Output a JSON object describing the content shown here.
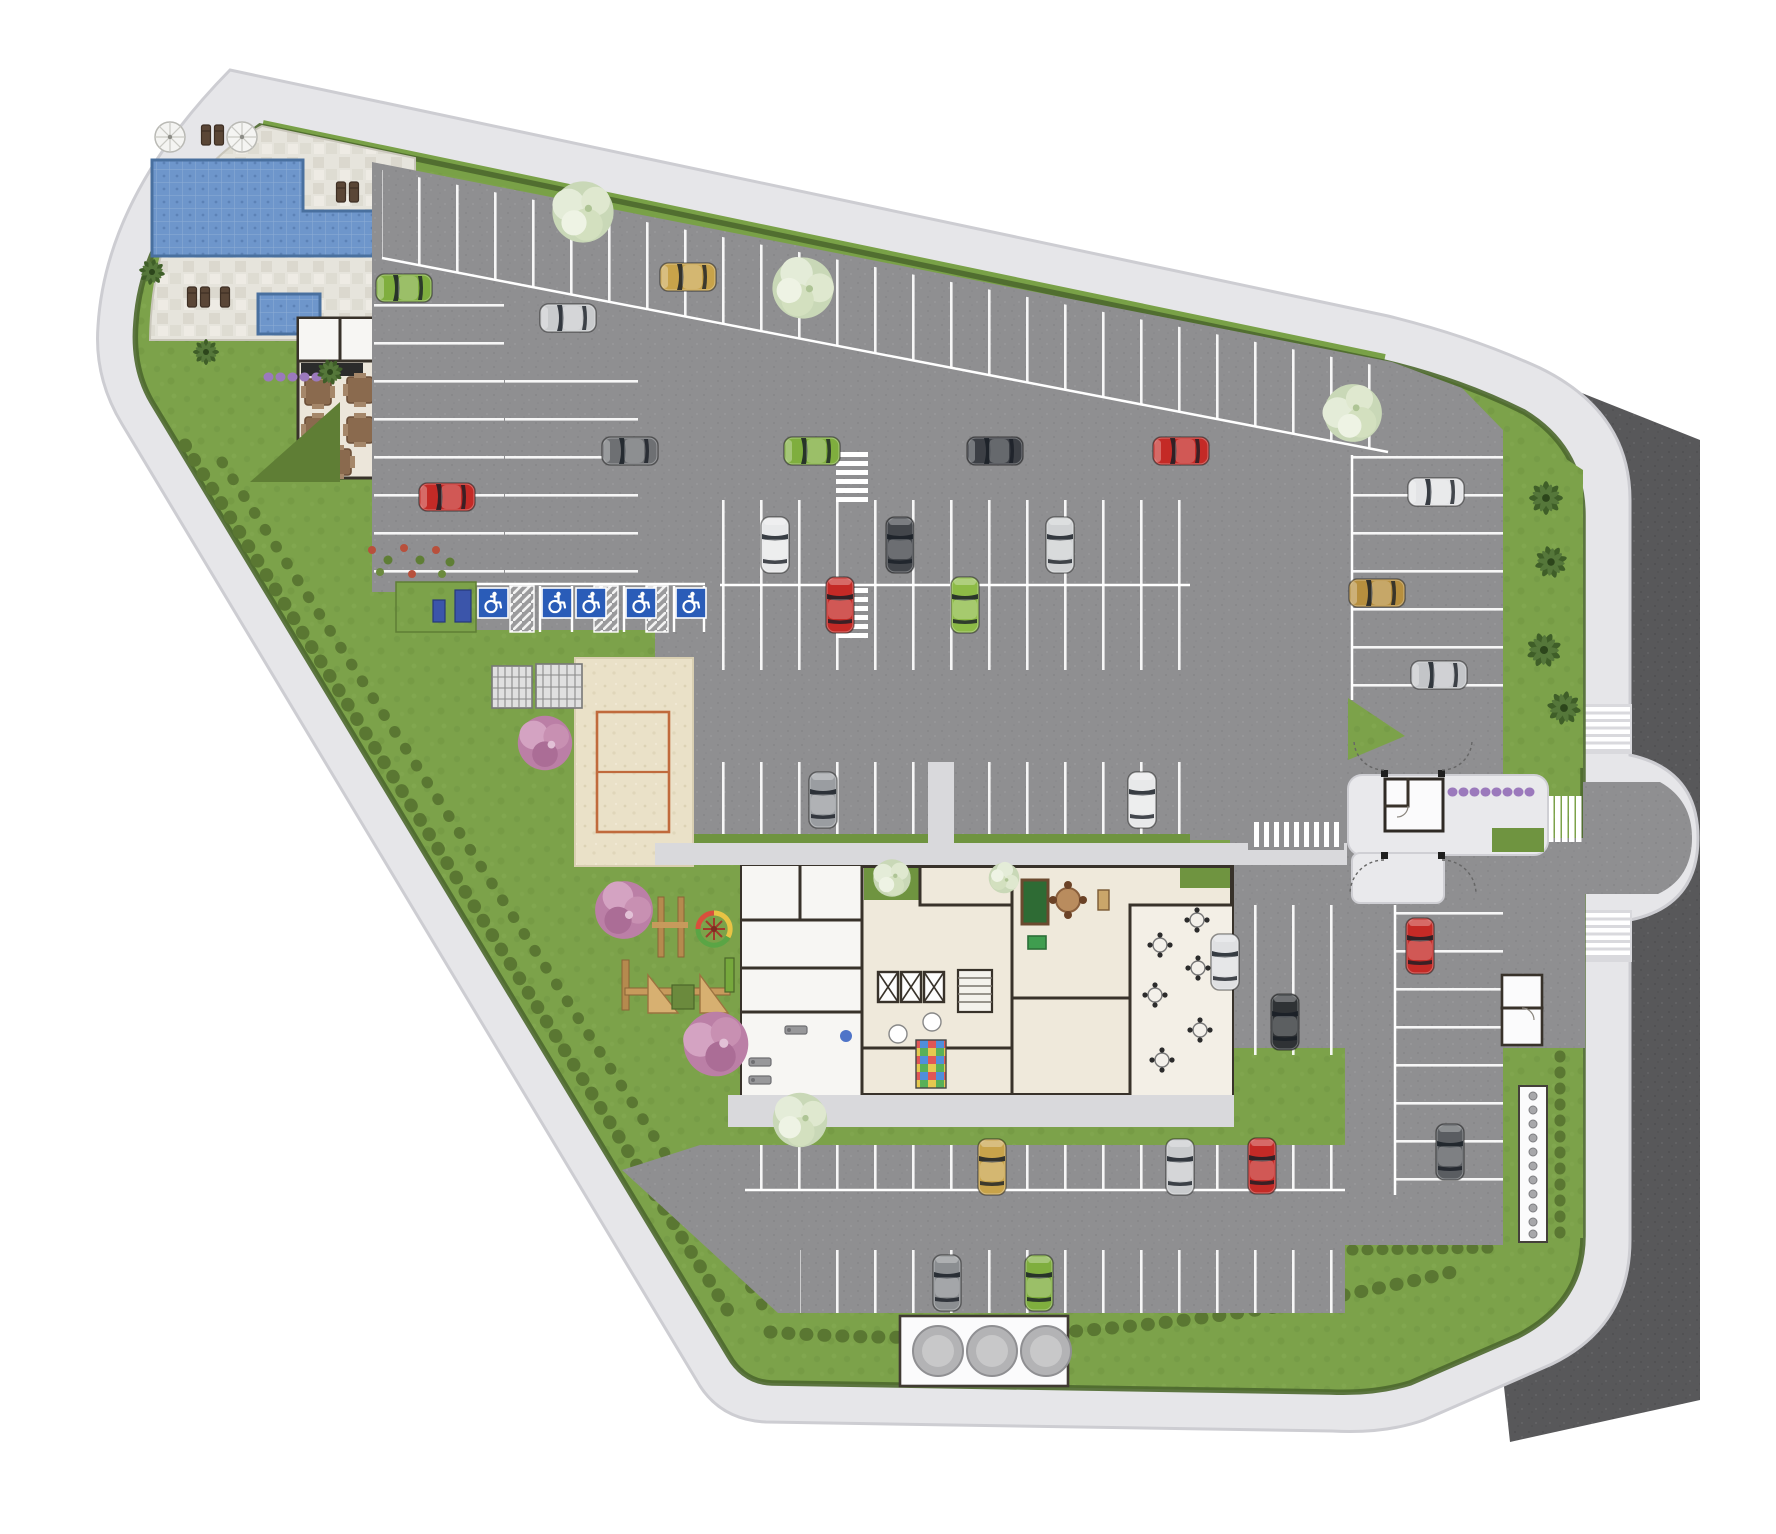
{
  "site": {
    "type": "residential-condominium-site-plan",
    "features": [
      "swimming-pool",
      "children-pool",
      "sun-deck",
      "pool-terrace-with-tables",
      "beach-sport-court",
      "playground",
      "apartment-building-floorplan",
      "party-room",
      "game-room",
      "gym",
      "guardhouse",
      "entrance-gate",
      "water-tanks",
      "perimeter-sidewalk",
      "street",
      "parking-lots"
    ],
    "counts": {
      "accessible_parking_spaces": 5,
      "water_tanks": 3,
      "elevators": 3,
      "pool_umbrellas": 2,
      "terrace_tables": 5,
      "party_room_tables": 6,
      "crosswalks": 6
    }
  },
  "colors": {
    "page": "#ffffff",
    "sidewalk": "#e6e6e9",
    "curb": "#cdcdd2",
    "road": "#58585a",
    "asphalt": "#8f8f91",
    "stall_line": "#ffffff",
    "lawn": "#7ca24a",
    "verge_green": "#6f9440",
    "hedge": "#4d682d",
    "shrub": "#5a7732",
    "pool": "#6e96cb",
    "pool_edge": "#49709f",
    "deck": "#e6e4dc",
    "deck_stone": "#d8d5cb",
    "sand": "#eae1c8",
    "court_line": "#c06a3c",
    "building_wall": "#38322a",
    "floor_beige": "#efe9db",
    "floor_white": "#f7f6f3",
    "walkway": "#d9d9dc",
    "accessible_blue": "#2a5cb8",
    "tank": "#b3b3b5",
    "tank_pad": "#fbfbfc",
    "flower_purple": "#9b79bc",
    "tree_pink": "#bb7fa6",
    "tree_white": "#dce7cb",
    "palm": "#3f5e28",
    "pool_table_green": "#2e6b34",
    "play_wood": "#b58a4e"
  },
  "icons": {
    "accessible_space": "wheelchair-icon",
    "elevator": "elevator-x-icon",
    "umbrella": "parasol-icon"
  },
  "cars": [
    {
      "color": "#7fae3e",
      "orientation": "horizontal"
    },
    {
      "color": "#c9cbcd",
      "orientation": "horizontal"
    },
    {
      "color": "#c8a34a",
      "orientation": "horizontal"
    },
    {
      "color": "#6e7073",
      "orientation": "horizontal"
    },
    {
      "color": "#7fae3e",
      "orientation": "horizontal"
    },
    {
      "color": "#3c3f45",
      "orientation": "horizontal"
    },
    {
      "color": "#c42a26",
      "orientation": "horizontal"
    },
    {
      "color": "#c42a26",
      "orientation": "horizontal"
    },
    {
      "color": "#e8e9ea",
      "orientation": "vertical"
    },
    {
      "color": "#c42a26",
      "orientation": "vertical"
    },
    {
      "color": "#43464b",
      "orientation": "vertical"
    },
    {
      "color": "#8dbb46",
      "orientation": "vertical"
    },
    {
      "color": "#cfd1d3",
      "orientation": "vertical"
    },
    {
      "color": "#9a9da1",
      "orientation": "vertical"
    },
    {
      "color": "#e8e9ea",
      "orientation": "vertical"
    },
    {
      "color": "#e3e4e6",
      "orientation": "horizontal"
    },
    {
      "color": "#b78f3e",
      "orientation": "horizontal"
    },
    {
      "color": "#c3c5c8",
      "orientation": "horizontal"
    },
    {
      "color": "#c42a26",
      "orientation": "vertical"
    },
    {
      "color": "#5a5d61",
      "orientation": "vertical"
    },
    {
      "color": "#dfe0e2",
      "orientation": "vertical"
    },
    {
      "color": "#2f3235",
      "orientation": "vertical"
    },
    {
      "color": "#c8a34a",
      "orientation": "vertical"
    },
    {
      "color": "#c9cbcd",
      "orientation": "vertical"
    },
    {
      "color": "#c42a26",
      "orientation": "vertical"
    },
    {
      "color": "#8b8e91",
      "orientation": "vertical"
    },
    {
      "color": "#7fae3e",
      "orientation": "vertical"
    }
  ]
}
